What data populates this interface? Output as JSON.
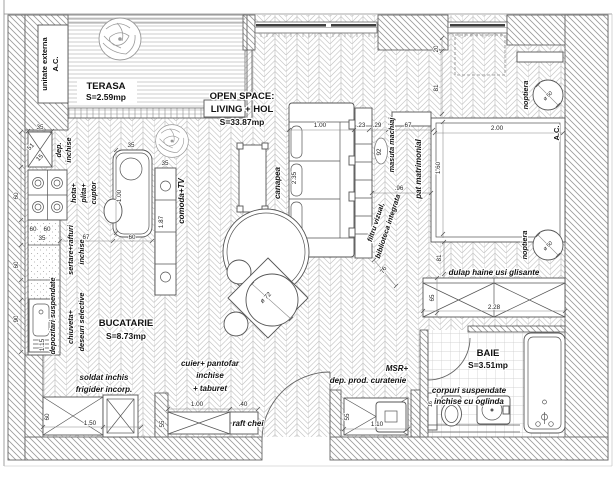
{
  "plan_title": "apartment floor plan",
  "rooms": {
    "terasa": {
      "name": "TERASA",
      "area": "S=2.59mp"
    },
    "open_space": {
      "name1": "OPEN SPACE:",
      "name2": "LIVING + HOL",
      "area": "S=33.87mp"
    },
    "bucatarie": {
      "name": "BUCATARIE",
      "area": "S=8.73mp"
    },
    "baie": {
      "name": "BAIE",
      "area": "S=3.51mp"
    }
  },
  "labels": {
    "unitate_externa_1": "unitate externa",
    "unitate_externa_2": "A.C.",
    "dep_1": "dep.",
    "dep_2": "inchise",
    "hota_1": "hota+",
    "hota_2": "plita+",
    "hota_3": "cuptor",
    "sertare_1": "sertare+rafturi",
    "sertare_2": "inchise",
    "chiuveta_1": "chiuveta+",
    "chiuveta_2": "deseuri selective",
    "depozitari": "depozitari suspendate",
    "comoda": "comoda+TV",
    "canapea": "canapea",
    "filtru_1": "filtru vizual,",
    "filtru_2": "biblioteca integrata",
    "masuta": "masuta machiaj",
    "pat": "pat matrimonial",
    "noptiera_top": "noptiera",
    "noptiera_bottom": "noptiera",
    "ac_bedroom": "A.C.",
    "dulap": "dulap haine usi glisante",
    "corpuri_1": "corpuri suspendate",
    "corpuri_2": "inchise cu oglinda",
    "msr_1": "MSR+",
    "msr_2": "dep. prod. curatenie",
    "soldat_1": "soldat inchis",
    "soldat_2": "frigider incorp.",
    "cuier_1": "cuier+ pantofar",
    "cuier_2": "inchise",
    "cuier_3": "+ taburet",
    "raft_chei": "raft chei"
  },
  "dims": {
    "dep_w": "35",
    "dep_diag_a": "51",
    "dep_diag_b": "15",
    "stove_h": "60",
    "counter_a": "60",
    "counter_b": "60",
    "counter_c": "35",
    "counter_d": "60",
    "sink_h": "90",
    "sink_len": "1.15",
    "cab_len": "1.50",
    "cab_d": "60",
    "aisle": "67",
    "island_w": "60",
    "island_top": "35",
    "island_len": "1.00",
    "comoda_top": "35",
    "comoda_len": "1.87",
    "sofa_w": "1.00",
    "sofa_len": "2.35",
    "table_dia": "ø 72",
    "gap_a": ".23",
    "gap_b": ".29",
    "gap_c": "67",
    "machiaj_len": "92",
    "machiaj_gap": ".96",
    "shelf_diag": "76",
    "win_gap": "20",
    "opening_a": "81",
    "opening_b": "81",
    "bed_w": "2.00",
    "bed_l": "1.60",
    "nopt_a": "ø 50",
    "nopt_b": "ø 50",
    "dulap_len": "2.28",
    "dulap_d": "65",
    "baie_shelf": "16",
    "msr_d": "55",
    "msr_len": "1.10",
    "cuier_d": "55",
    "cuier_len": "1.00",
    "raft_w": ".40"
  }
}
